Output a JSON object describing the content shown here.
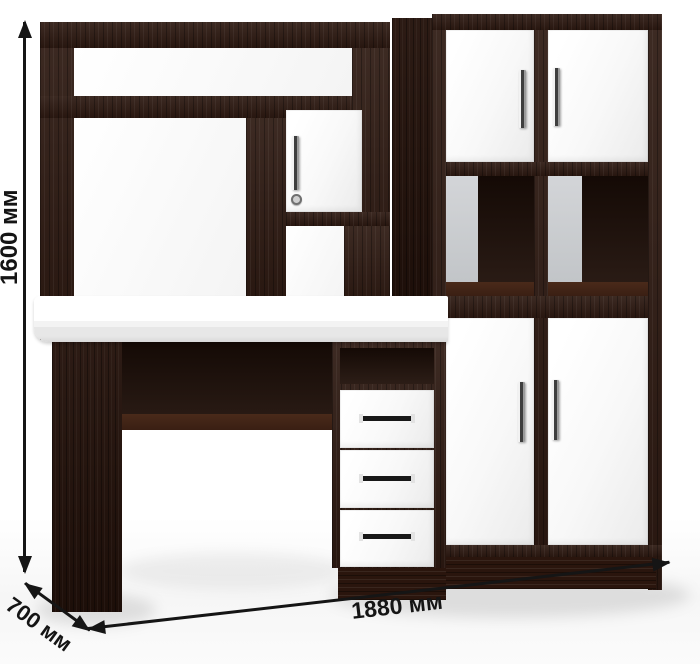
{
  "annotations": {
    "height": "1600 мм",
    "width": "1880 мм",
    "depth": "700 мм"
  },
  "colors": {
    "wood_dark": "#2e1a12",
    "wood_deep": "#1f0f08",
    "front_white": "#fcfcfc",
    "back_panel_gray": "#d3d5d8",
    "annotation_black": "#151515",
    "background": "#ffffff"
  }
}
